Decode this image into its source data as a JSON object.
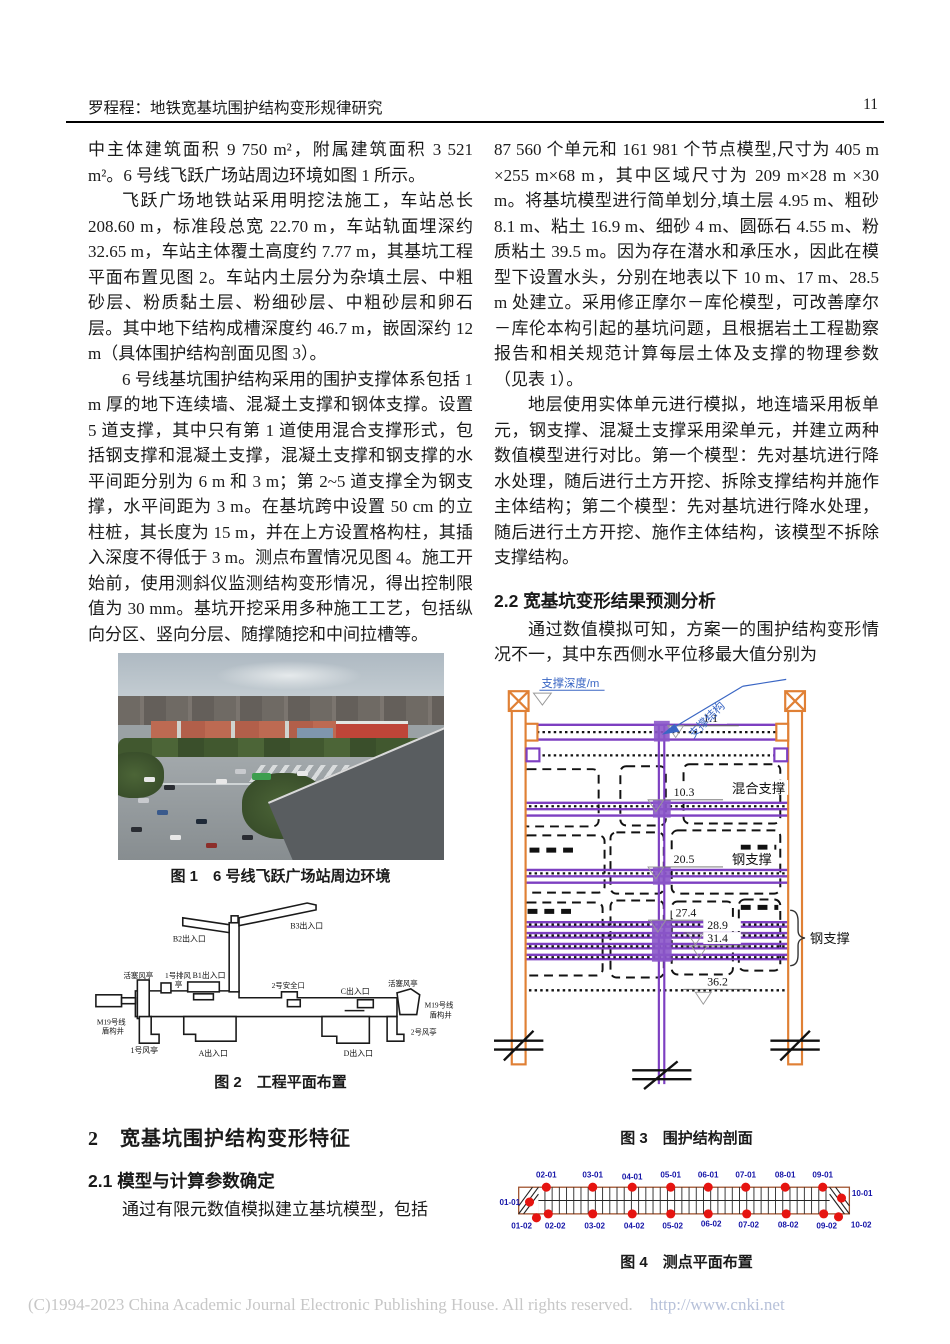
{
  "header": {
    "running_title": "罗程程：地铁宽基坑围护结构变形规律研究",
    "page_number": "11"
  },
  "left": {
    "para1": "中主体建筑面积 9 750 m²，附属建筑面积 3 521 m²。6 号线飞跃广场站周边环境如图 1 所示。",
    "para2": "飞跃广场地铁站采用明挖法施工，车站总长 208.60 m，标准段总宽 22.70 m，车站轨面埋深约 32.65 m，车站主体覆土高度约 7.77 m，其基坑工程平面布置见图 2。车站内土层分为杂填土层、中粗砂层、粉质黏土层、粉细砂层、中粗砂层和卵石层。其中地下结构成槽深度约 46.7 m，嵌固深约 12 m（具体围护结构剖面见图 3）。",
    "para3": "6 号线基坑围护结构采用的围护支撑体系包括 1 m 厚的地下连续墙、混凝土支撑和钢体支撑。设置 5 道支撑，其中只有第 1 道使用混合支撑形式，包括钢支撑和混凝土支撑，混凝土支撑和钢支撑的水平间距分别为 6 m 和 3 m；第 2~5 道支撑全为钢支撑，水平间距为 3 m。在基坑跨中设置 50 cm 的立柱桩，其长度为 15 m，并在上方设置格构柱，其插入深度不得低于 3 m。测点布置情况见图 4。施工开始前，使用测斜仪监测结构变形情况，得出控制限值为 30 mm。基坑开挖采用多种施工工艺，包括纵向分区、竖向分层、随撑随挖和中间拉槽等。",
    "fig1_caption": "图 1　6 号线飞跃广场站周边环境",
    "fig2_caption": "图 2　工程平面布置",
    "section2": "2　宽基坑围护结构变形特征",
    "section21": "2.1 模型与计算参数确定",
    "para4": "通过有限元数值模拟建立基坑模型，包括"
  },
  "right": {
    "para1": "87 560 个单元和 161 981 个节点模型,尺寸为 405 m ×255 m×68 m，其中区域尺寸为 209 m×28 m ×30 m。将基坑模型进行简单划分,填土层 4.95 m、粗砂 8.1 m、粘土 16.9 m、细砂 4 m、圆砾石 4.55 m、粉质粘土 39.5 m。因为存在潜水和承压水，因此在模型下设置水头，分别在地表以下 10 m、17 m、28.5 m 处建立。采用修正摩尔－库伦模型，可改善摩尔－库伦本构引起的基坑问题，且根据岩土工程勘察报告和相关规范计算每层土体及支撑的物理参数（见表 1）。",
    "para2": "地层使用实体单元进行模拟，地连墙采用板单元，钢支撑、混凝土支撑采用梁单元，并建立两种数值模型进行对比。第一个模型：先对基坑进行降水处理，随后进行土方开挖、拆除支撑结构并施作主体结构；第二个模型：先对基坑进行降水处理，随后进行土方开挖、施作主体结构，该模型不拆除支撑结构。",
    "section22": "2.2 宽基坑变形结果预测分析",
    "para3": "通过数值模拟可知，方案一的围护结构变形情况不一，其中东西侧水平位移最大值分别为",
    "fig3_caption": "图 3　围护结构剖面",
    "fig4_caption": "图 4　测点平面布置"
  },
  "figure2_labels": {
    "b2": "B2出入口",
    "b3": "B3出入口",
    "piston_left": "活塞风亭",
    "exhaust_line1": "1号排风",
    "exhaust_line2": "亭",
    "b1": "B1出入口",
    "safety2": "2号安全口",
    "c": "C出入口",
    "piston_right": "活塞风亭",
    "m19_right_line1": "M19号线",
    "m19_right_line2": "盾构井",
    "fan2": "2号风亭",
    "m19_left_line1": "M19号线",
    "m19_left_line2": "盾构井",
    "fan1": "1号风亭",
    "a": "A出入口",
    "d": "D出入口"
  },
  "figure3": {
    "depth_axis_label": "支撑深度/m",
    "support_structure_label": "支撑结构",
    "mixed_support_label": "混合支撑",
    "steel_support_mid_label": "钢支撑",
    "steel_support_lower_label": "钢支撑",
    "depths": [
      "1.1",
      "10.3",
      "20.5",
      "27.4",
      "28.9",
      "31.4",
      "36.2"
    ],
    "colors": {
      "wall": "#E08035",
      "strut": "#7D3FC1",
      "annotation": "#3A66C4"
    }
  },
  "figure4": {
    "top": [
      "02-01",
      "03-01",
      "04-01",
      "05-01",
      "06-01",
      "07-01",
      "08-01",
      "09-01"
    ],
    "left": "01-01",
    "right": "10-01",
    "bottom": [
      "01-02",
      "02-02",
      "03-02",
      "04-02",
      "05-02",
      "06-02",
      "07-02",
      "08-02",
      "09-02",
      "10-02"
    ],
    "point_color": "#E61410",
    "label_color": "#1515A8"
  },
  "footer": {
    "copyright": "(C)1994-2023 China Academic Journal Electronic Publishing House. All rights reserved.",
    "url": "http://www.cnki.net"
  }
}
